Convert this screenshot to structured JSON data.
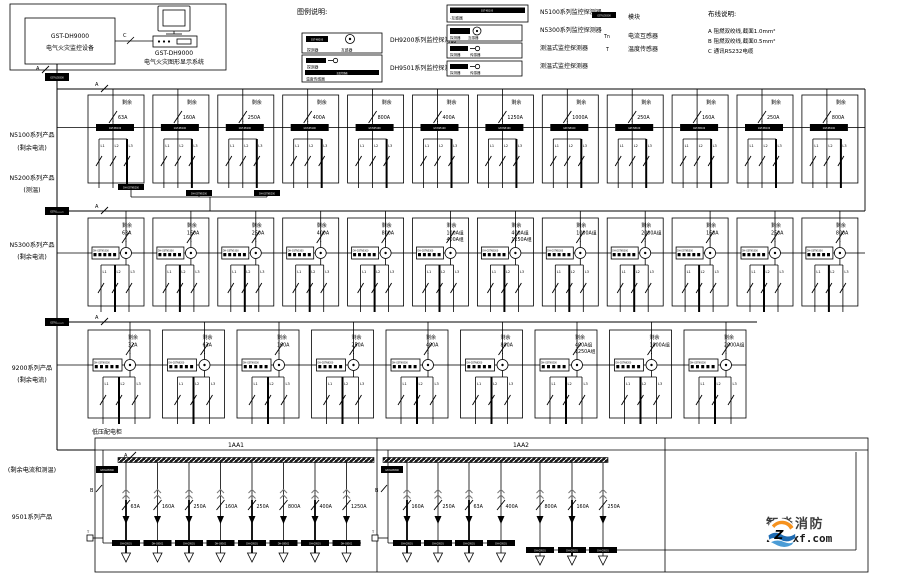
{
  "controller_block": {
    "device_name": "GST-DH9000",
    "device_desc": "电气火灾监控设备",
    "display_name": "GST-DH9000",
    "display_desc": "电气火灾图形显示系统",
    "link_label": "C"
  },
  "legend": {
    "title": "图例说明:",
    "mid_items": [
      {
        "bar_text": "GST-N9200",
        "cap1": "探测器",
        "cap2": "互感器",
        "label": "DH9200系列监控探测器"
      },
      {
        "bar_text": "GST-N9501",
        "cap1": "探测器",
        "bar_text2": "温度传感器",
        "cap2": "温度传感器",
        "label": "DH9501系列监控探测器"
      }
    ],
    "right_items": [
      {
        "bar_text": "GST-N5100",
        "cap1": "-互感器",
        "label": "N5100系列监控探测器"
      },
      {
        "bar_text": "GST-N5300",
        "cap1": "探测器",
        "cap2": "互感器",
        "label": "N5300系列监控探测器"
      },
      {
        "bar_text": "GST-9200",
        "cap1": "探测器",
        "cap2": "传感器",
        "label": "测温式监控探测器"
      },
      {
        "bar_text": "GST-9501",
        "cap1": "探测器",
        "cap2": "传感器",
        "label": "测温式监控探测器"
      }
    ],
    "symbol_items": [
      {
        "sym": "",
        "bar_text": "GST-LD8300",
        "label": "模块"
      },
      {
        "sym": "Tn",
        "label": "电流互感器"
      },
      {
        "sym": "T",
        "label": "温度传感器"
      }
    ]
  },
  "wiring_notes": {
    "title": "布线说明:",
    "lines": [
      "A 阻燃双绞线,截面1.0mm²",
      "B 阻燃双绞线,截面0.5mm²",
      "C 通讯RS232电缆"
    ]
  },
  "bus_label": "A",
  "phases": [
    "L1",
    "L2",
    "L3"
  ],
  "side_labels": [
    {
      "lines": [
        "N5100系列产品",
        "(剩余电流)"
      ]
    },
    {
      "lines": [
        "N5200系列产品",
        "(测温)"
      ]
    },
    {
      "lines": [
        "N5300系列产品",
        "(剩余电流)"
      ]
    },
    {
      "lines": [
        "9200系列产品",
        "(剩余电流)"
      ]
    },
    {
      "lines": [
        "(剩余电流和测温)"
      ]
    },
    {
      "lines": [
        "9501系列产品"
      ]
    }
  ],
  "rows": [
    {
      "name": "N5100",
      "tag": "剩余",
      "devices": [
        {
          "amps": [
            "63A"
          ]
        },
        {
          "amps": [
            "160A"
          ]
        },
        {
          "amps": [
            "250A"
          ]
        },
        {
          "amps": [
            "400A"
          ]
        },
        {
          "amps": [
            "800A"
          ]
        },
        {
          "amps": [
            "400A"
          ]
        },
        {
          "amps": [
            "1250A"
          ]
        },
        {
          "amps": [
            "1000A"
          ]
        },
        {
          "amps": [
            "250A"
          ]
        },
        {
          "amps": [
            "160A"
          ]
        },
        {
          "amps": [
            "250A"
          ]
        },
        {
          "amps": [
            "800A"
          ]
        }
      ]
    },
    {
      "name": "N5300",
      "tag": "剩余",
      "devices": [
        {
          "amps": [
            "63A"
          ]
        },
        {
          "amps": [
            "160A"
          ]
        },
        {
          "amps": [
            "250A"
          ]
        },
        {
          "amps": [
            "400A"
          ]
        },
        {
          "amps": [
            "800A"
          ]
        },
        {
          "amps": [
            "100A组",
            "400A组"
          ]
        },
        {
          "amps": [
            "400A组",
            "1250A组"
          ]
        },
        {
          "amps": [
            "1000A组"
          ]
        },
        {
          "amps": [
            "2000A组"
          ]
        },
        {
          "amps": [
            "160A"
          ]
        },
        {
          "amps": [
            "250A"
          ]
        },
        {
          "amps": [
            "800A"
          ]
        }
      ]
    },
    {
      "name": "9200",
      "tag": "剩余",
      "devices": [
        {
          "amps": [
            "32A"
          ]
        },
        {
          "amps": [
            "63A"
          ]
        },
        {
          "amps": [
            "160A"
          ]
        },
        {
          "amps": [
            "250A"
          ]
        },
        {
          "amps": [
            "400A"
          ]
        },
        {
          "amps": [
            "800A"
          ]
        },
        {
          "amps": [
            "400A组",
            "1250A组"
          ]
        },
        {
          "amps": [
            "1000A组"
          ]
        },
        {
          "amps": [
            "2000A组"
          ]
        }
      ]
    }
  ],
  "panels": [
    {
      "title": "1AA1",
      "cab_label": "低压配电柜",
      "bus_label": "A",
      "wire_label": "B",
      "t_label": "T",
      "branches": [
        {
          "amp": "63A",
          "thick": true
        },
        {
          "amp": "160A"
        },
        {
          "amp": "250A",
          "thick": true
        },
        {
          "amp": "160A"
        },
        {
          "amp": "250A",
          "thick": true
        },
        {
          "amp": "800A"
        },
        {
          "amp": "400A",
          "thick": true
        },
        {
          "amp": "1250A"
        }
      ]
    },
    {
      "title": "1AA2",
      "wire_label": "B",
      "t_label": "T",
      "branches": [
        {
          "amp": "160A",
          "thick": true
        },
        {
          "amp": "250A"
        },
        {
          "amp": "63A",
          "thick": true
        },
        {
          "amp": "400A"
        },
        {
          "amp": "800A"
        },
        {
          "amp": "160A",
          "thick": true
        },
        {
          "amp": "250A"
        }
      ]
    }
  ],
  "device_texts": {
    "trunk_module": "GST-LD8300",
    "panel_module": "GST-LD8300",
    "row1_bar": "GST-N5100",
    "row2_box": "DH-GSTN5300",
    "row3_box": "DH-GSTN9200",
    "branch_bar": "DH-G9501",
    "n5200_bar": "DH-GSTN5200"
  },
  "watermark": {
    "brand": "智淼消防",
    "site": "zmjaxf.com"
  }
}
